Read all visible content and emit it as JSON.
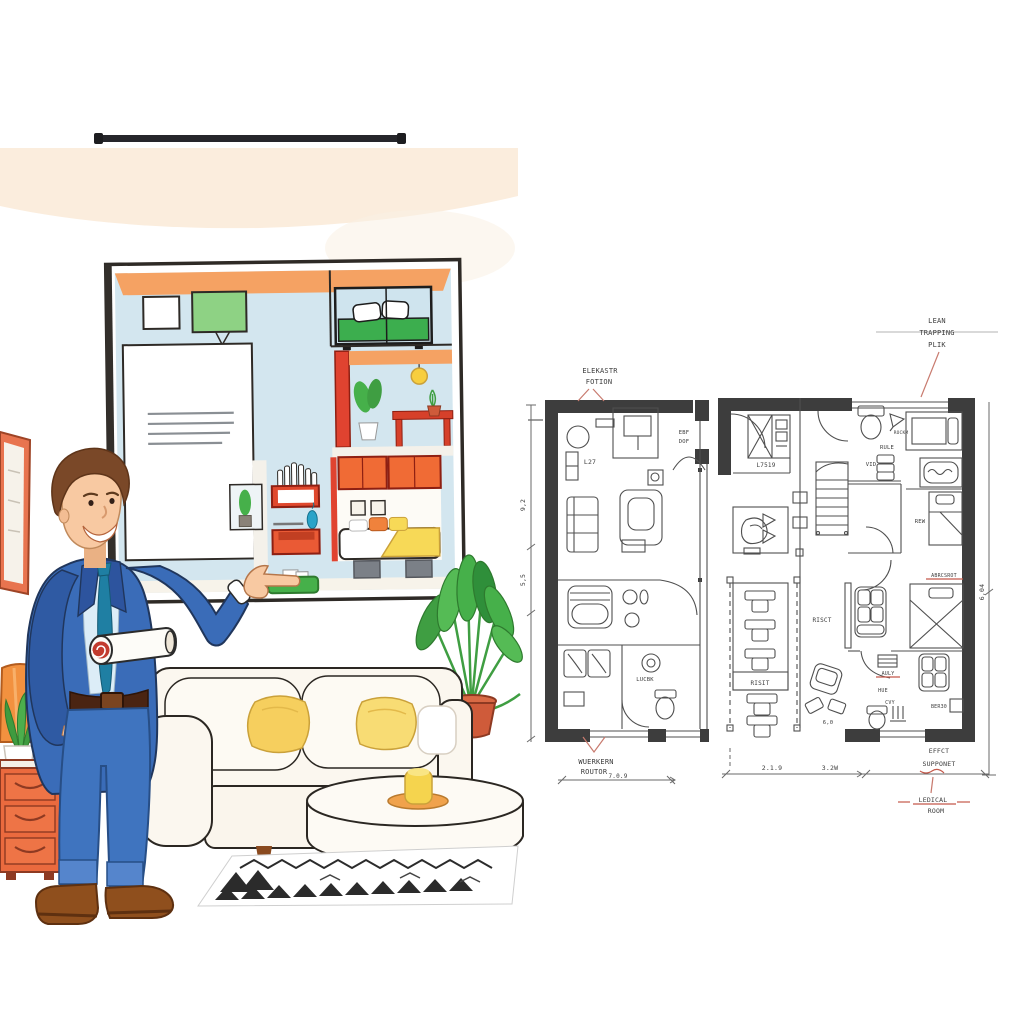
{
  "floor_plan": {
    "callouts": {
      "elevator_line1": "ELEKASTR",
      "elevator_line2": "FOTION",
      "lean_line1": "LEAN",
      "lean_line2": "TRAPPING",
      "lean_line3": "PLIK",
      "workroom_line1": "WUERKERN",
      "workroom_line2": "ROUTOR",
      "effect_line1": "EFFCT",
      "effect_line2": "SUPPONET",
      "medical_line1": "LEDICAL",
      "medical_line2": "ROOM"
    },
    "rooms": {
      "living": "L27",
      "entry_door_line1": "EBF",
      "entry_door_line2": "DOF",
      "bath": "LUCBK",
      "suite": "L7519",
      "rockm": "ROCKM",
      "rule": "RULE",
      "vid": "VID",
      "rew": "REW",
      "risit": "RISIT",
      "risct": "RISCT",
      "seat_dim": "6,0",
      "abrcsrot": "ABRCSROT",
      "auly": "AULY",
      "hue": "HUE",
      "cvy": "CVY",
      "ber30": "BER30"
    },
    "dimensions": {
      "left_upper": "9,2",
      "left_lower": "5,5",
      "right_side": "6,04",
      "bottom_left_unit": "7.0.9",
      "bottom_right_a": "2.1.9",
      "bottom_right_b": "3.2W"
    }
  },
  "illustration": {
    "items": [
      "presenter-man",
      "rolled-blueprint",
      "interior-cutaway-poster",
      "sofa",
      "yellow-pillows",
      "coffee-table",
      "candle",
      "rug",
      "palm-plant",
      "aloe-plant",
      "floor-lamp",
      "dresser",
      "wall-picture",
      "curtain-rail"
    ]
  },
  "colors": {
    "annotation_red": "#c4584a",
    "plan_ink": "#4f4f4f",
    "wall_fill": "#3d3d3d",
    "accent_orange": "#ec6a3a",
    "suit_blue": "#3a6cb8",
    "tie_teal": "#1f7fa3",
    "pillow_yellow": "#f6cf5e",
    "bed_green": "#3cae4e",
    "wall_band_peach": "#fbeddd",
    "poster_blue": "#d3e6ef"
  }
}
